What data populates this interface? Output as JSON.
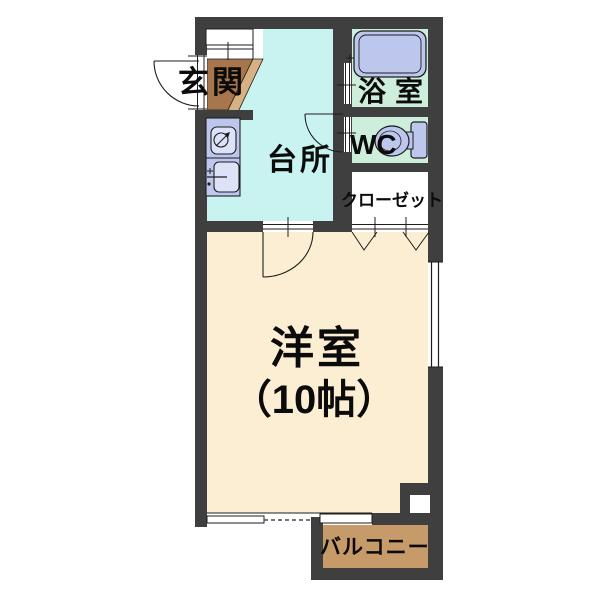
{
  "plan": {
    "type": "apartment-floor-plan",
    "rooms": {
      "entrance": {
        "label": "玄関"
      },
      "kitchen": {
        "label": "台所"
      },
      "bathroom": {
        "label": "浴室"
      },
      "toilet": {
        "label": "WC"
      },
      "closet": {
        "label": "クローゼット"
      },
      "main_room": {
        "label": "洋室",
        "size_label": "（10帖）"
      },
      "balcony": {
        "label": "バルコニー"
      }
    }
  },
  "colors": {
    "wall": "#3f3f3f",
    "kitchen_floor": "#c9f3f1",
    "main_room_floor": "#fbeed3",
    "wet_area_floor": "#cdeeda",
    "fixture": "#bdc7ee",
    "fixture_light": "#dce2f8",
    "entry_tile_dark": "#a8764d",
    "entry_tile_light": "#d7b083",
    "balcony_floor": "#c79b69",
    "line": "#1e1e1e",
    "white": "#ffffff"
  }
}
